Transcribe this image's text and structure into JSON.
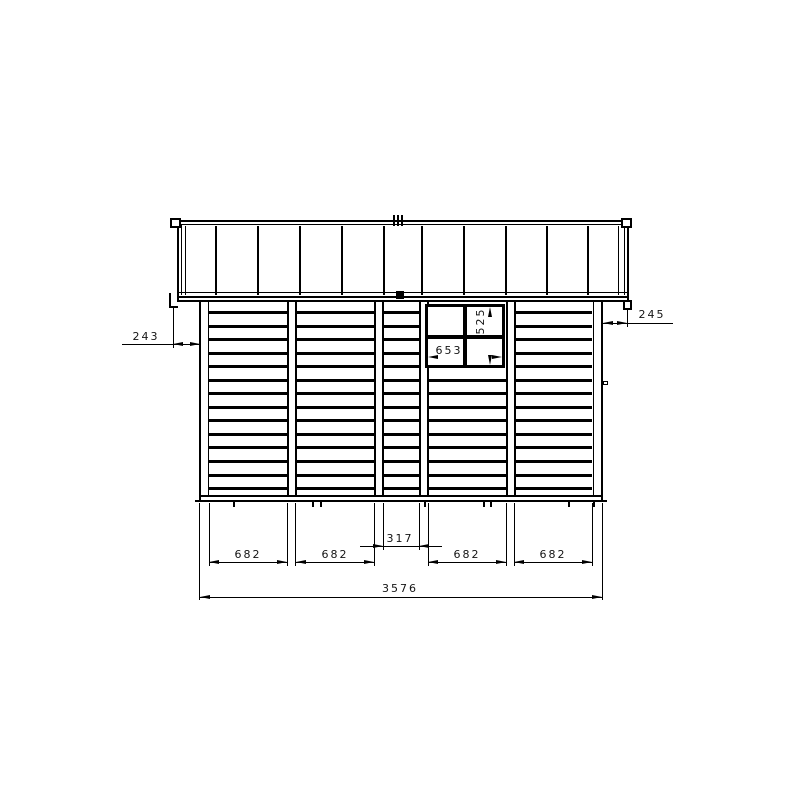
{
  "dimensions": {
    "roof_overhang_left": "243",
    "roof_overhang_right": "245",
    "window_width": "653",
    "window_height": "525",
    "bay_width_1": "682",
    "bay_width_2": "682",
    "bay_width_center": "317",
    "bay_width_4": "682",
    "bay_width_5": "682",
    "total_width": "3576"
  }
}
